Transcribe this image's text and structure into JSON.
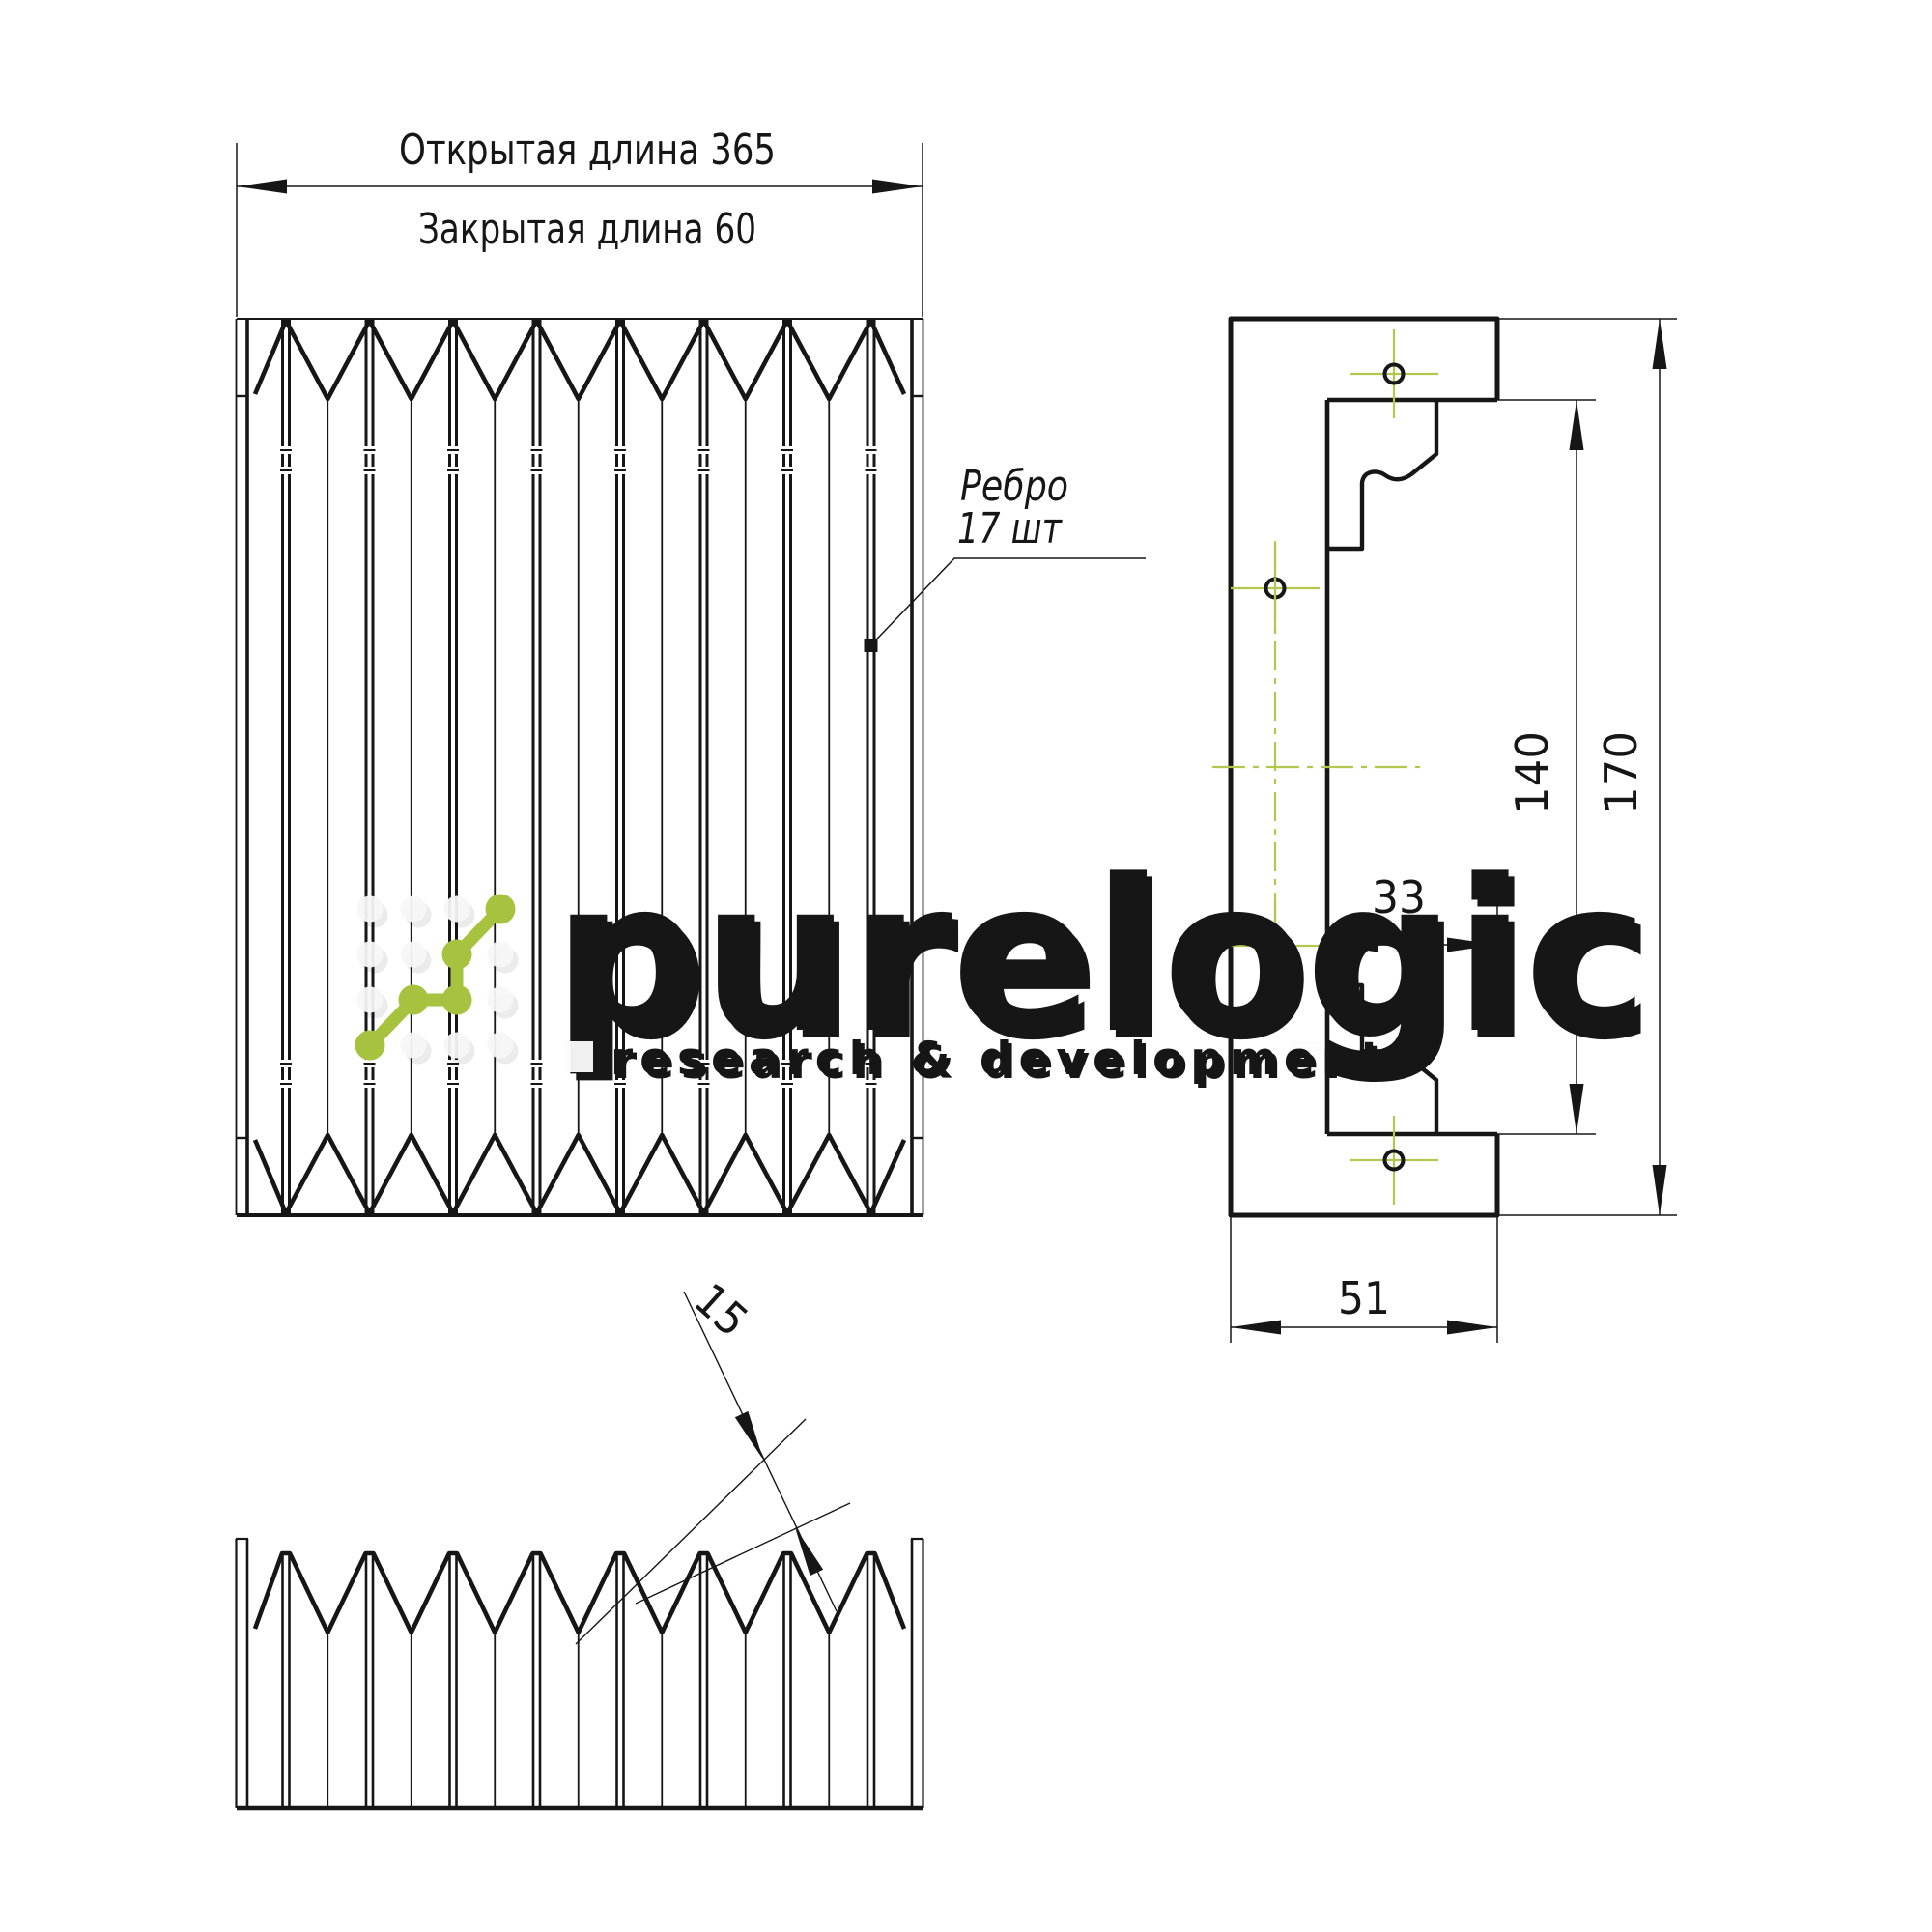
{
  "drawing": {
    "type": "bellows-cover-technical-drawing",
    "labels": {
      "open_length": "Открытая длина 365",
      "closed_length": "Закрытая длина 60",
      "callout_line1": "Ребро",
      "callout_line2": "17 шт"
    },
    "dimensions": {
      "inner_height": "140",
      "outer_height": "170",
      "lip_width": "33",
      "base_width": "51",
      "pleat_pitch": "15"
    },
    "bellows": {
      "rib_count": 17,
      "modules": 8
    },
    "colors": {
      "line": "#161616",
      "centerline": "#b2c74e",
      "logo_green": "#a6c23f",
      "watermark_white": "#fafafa"
    }
  },
  "watermark": {
    "brand": "purelogic",
    "subtitle": "research & development"
  }
}
